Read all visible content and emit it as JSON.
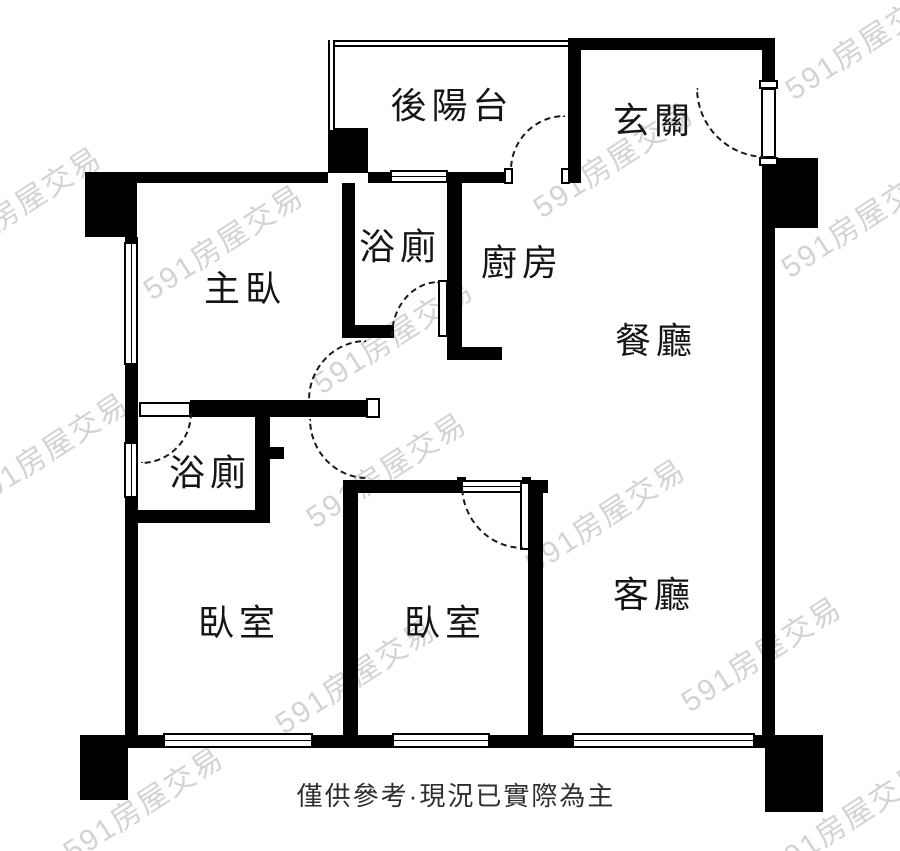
{
  "document": {
    "type": "apartment-floor-plan",
    "canvas": {
      "width": 900,
      "height": 851
    },
    "colors": {
      "wall": "#000000",
      "background": "#ffffff",
      "watermark": "#d3d3d3",
      "label_text": "#151515"
    }
  },
  "rooms": [
    {
      "id": "rear-balcony",
      "label": "後陽台"
    },
    {
      "id": "entrance",
      "label": "玄關"
    },
    {
      "id": "bathroom-upper",
      "label": "浴廁"
    },
    {
      "id": "kitchen",
      "label": "廚房"
    },
    {
      "id": "master-bedroom",
      "label": "主臥"
    },
    {
      "id": "dining-room",
      "label": "餐廳"
    },
    {
      "id": "bathroom-lower",
      "label": "浴廁"
    },
    {
      "id": "bedroom-left",
      "label": "臥室"
    },
    {
      "id": "bedroom-middle",
      "label": "臥室"
    },
    {
      "id": "living-room",
      "label": "客廳"
    }
  ],
  "caption": {
    "text": "僅供參考·現況已實際為主"
  },
  "watermark": {
    "text": "591房屋交易"
  }
}
